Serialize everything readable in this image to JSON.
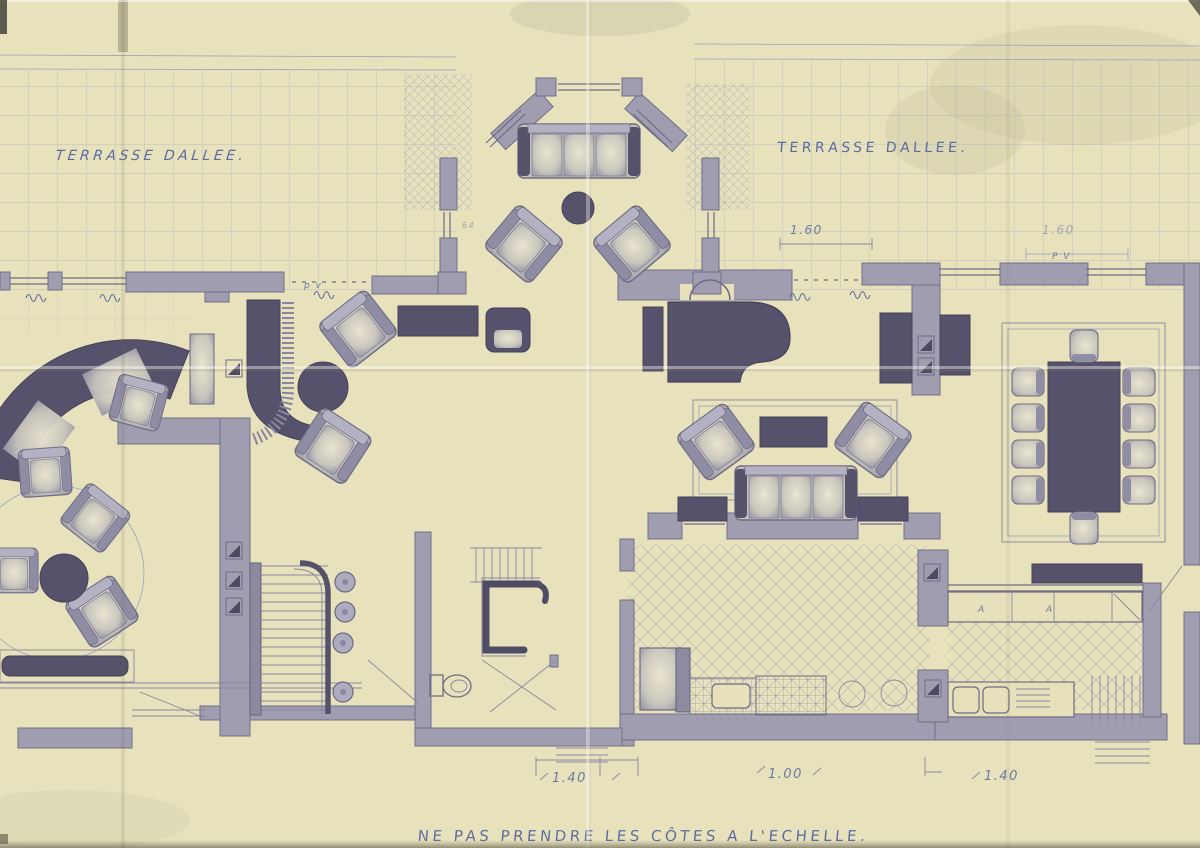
{
  "plan": {
    "terrace_left_label": "TERRASSE DALLEE.",
    "terrace_right_label": "TERRASSE DALLEE.",
    "bottom_note": "NE PAS PRENDRE LES CÔTES A L'ECHELLE.",
    "dimensions": {
      "bay_window": "1.60",
      "dining_window": "1.60",
      "left_opening": "1.40",
      "center_opening": "1.00",
      "right_opening": "1.40"
    },
    "marks": {
      "pv_left": "p v",
      "pv_right": "P V",
      "cabinet_a_1": "A",
      "cabinet_a_2": "A",
      "bay_mark": "64"
    },
    "colors": {
      "paper": "#eae5bd",
      "ink_blue": "#5d6ca0",
      "pencil_gray": "#6e6c86",
      "wall_gray": "#a09db0",
      "furniture_dark": "#56526c",
      "grid_blue": "#98a2bc"
    }
  }
}
